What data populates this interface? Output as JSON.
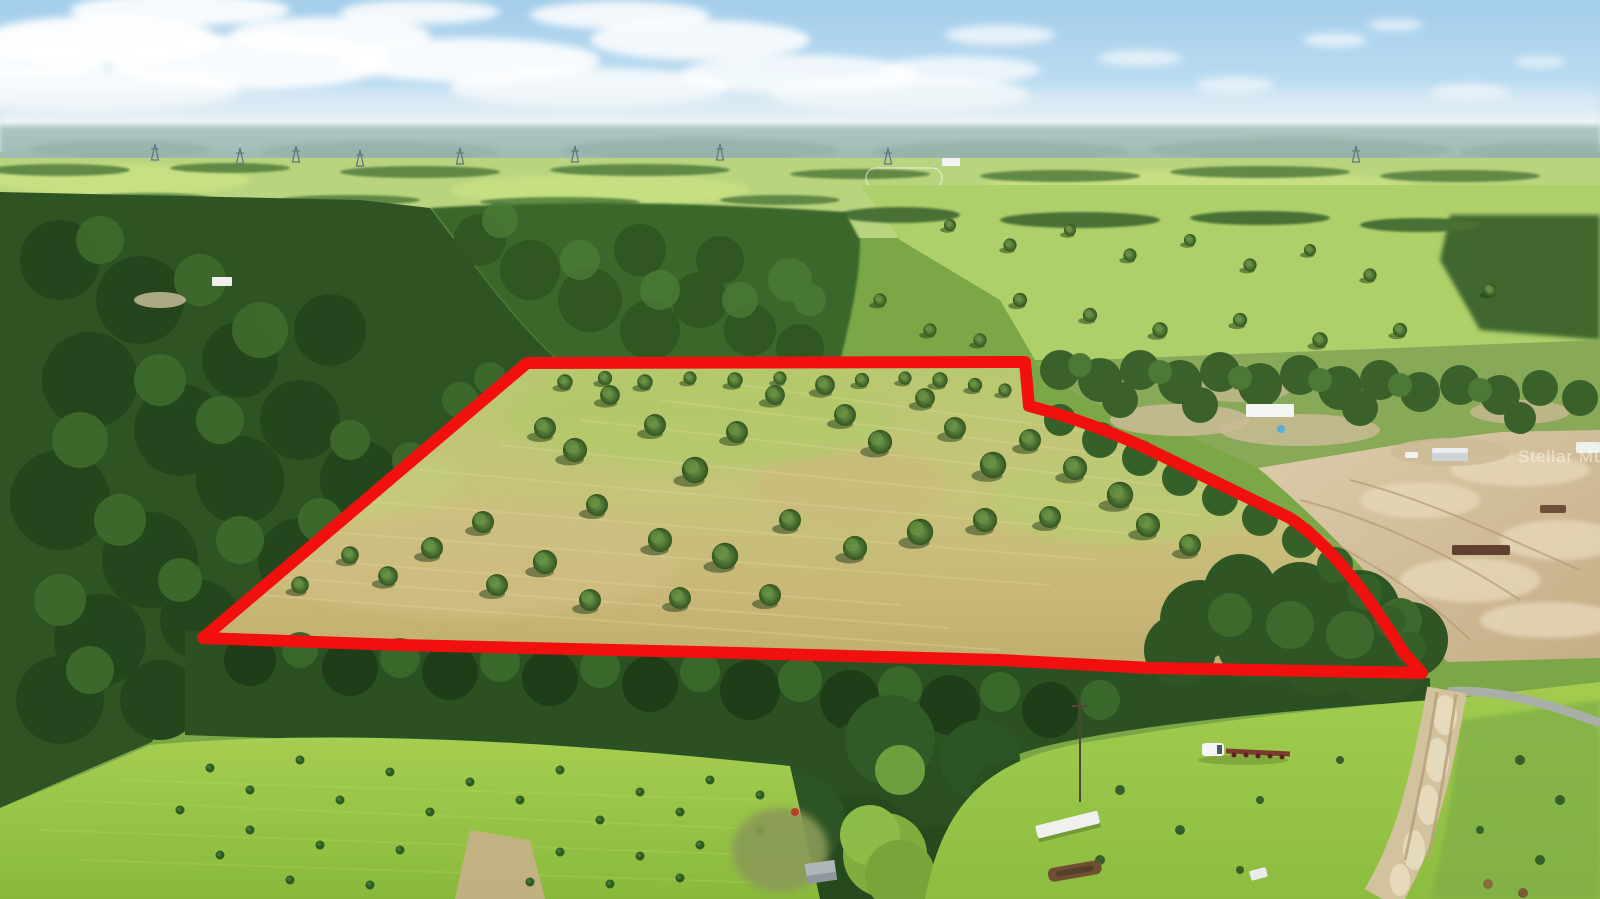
{
  "image": {
    "kind": "aerial-property-photo",
    "subject": "Aerial view of a cleared oak pasture parcel outlined in red, surrounded by pine forest, pastures and dirt-cleared lots",
    "width_px": 1600,
    "height_px": 899
  },
  "watermark": {
    "text": "Stellar MLS",
    "opacity": "0.5"
  },
  "boundary": {
    "color": "#f2100f",
    "stroke_width": "12"
  },
  "palette": {
    "sky_top": "#a3cdea",
    "sky_horizon": "#eff5f8",
    "distant_haze": "#cfe0ea",
    "field_bright": "#a6ce51",
    "forest_dark": "#2e5424",
    "pasture_tan": "#c7c37b",
    "dirt_sand": "#d5c3a0",
    "road_gray": "#a7afa6"
  }
}
